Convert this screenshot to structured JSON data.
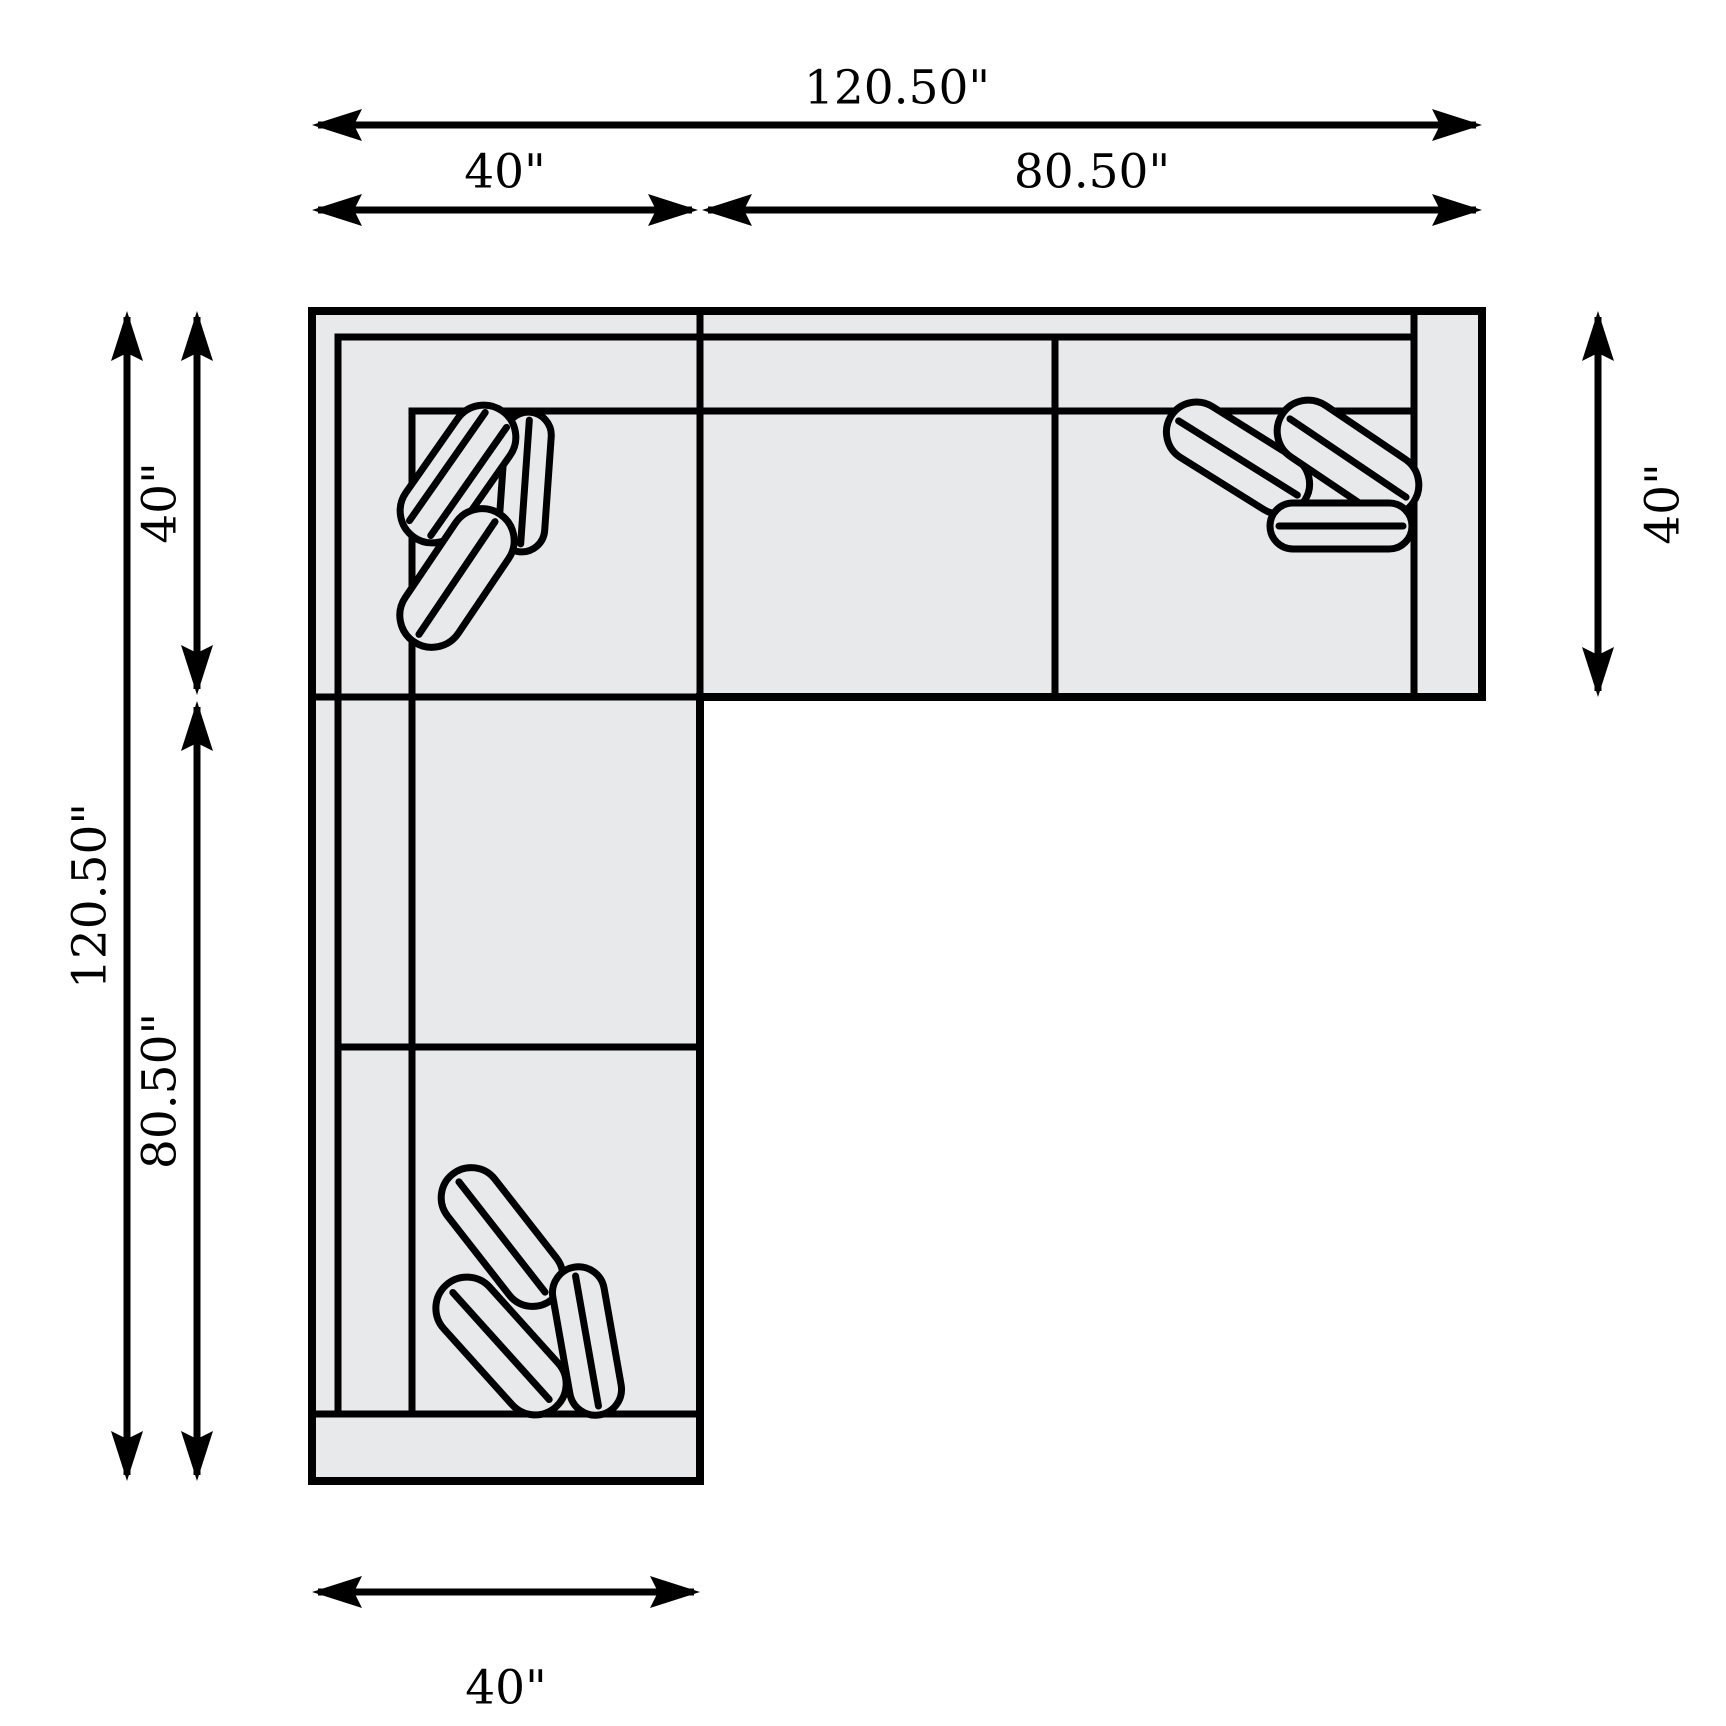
{
  "diagram": {
    "type": "sectional-sofa-top-view-dimension-drawing",
    "background_color": "#ffffff",
    "sofa_fill_color": "#e8e9eb",
    "line_color": "#000000",
    "dimensions": {
      "top_total": "120.50\"",
      "top_left": "40\"",
      "top_right": "80.50\"",
      "left_total": "120.50\"",
      "left_upper": "40\"",
      "left_lower": "80.50\"",
      "right_side": "40\"",
      "bottom": "40\""
    }
  }
}
